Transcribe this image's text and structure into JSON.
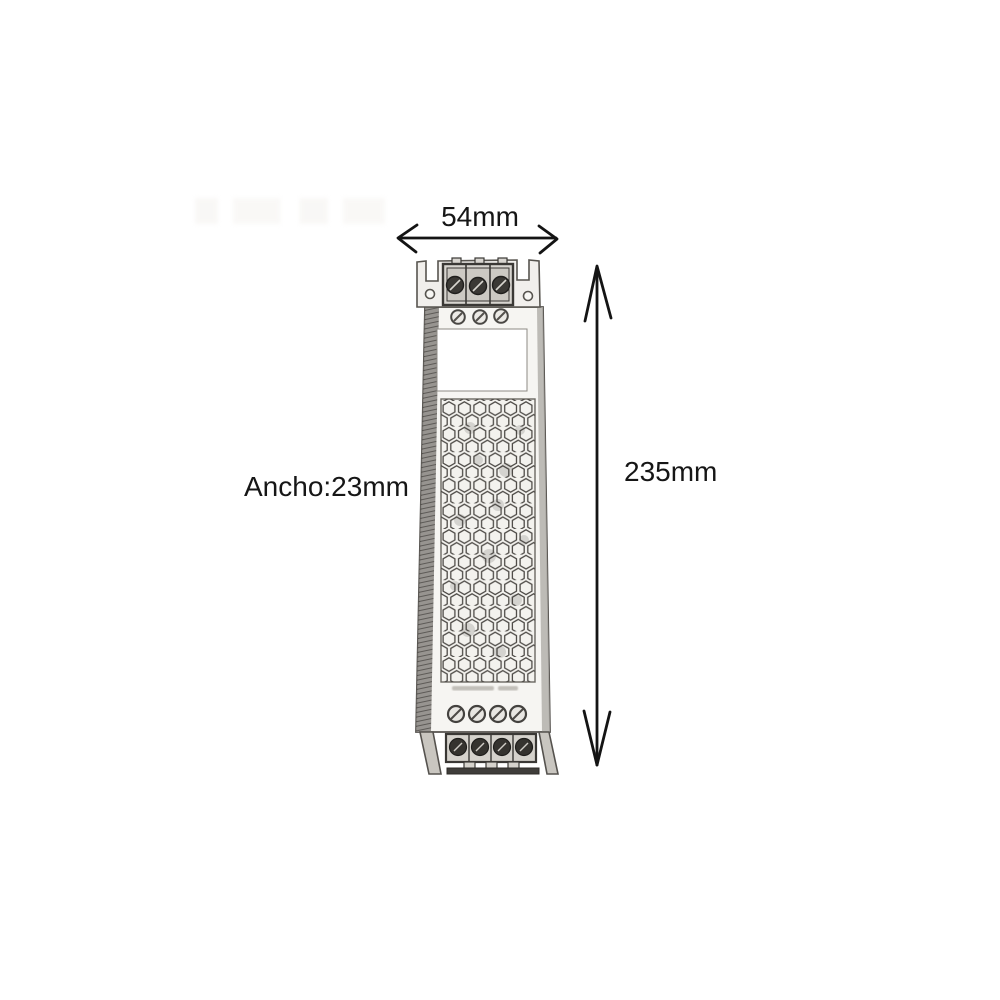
{
  "canvas": {
    "width_px": 1000,
    "height_px": 1000,
    "background": "#ffffff"
  },
  "dimension_labels": {
    "width": "54mm",
    "height": "235mm",
    "depth": "Ancho:23mm"
  },
  "drawing": {
    "subject": "slim LED driver power supply, top view, pencil-sketch style",
    "vent_pattern": "hexagonal honeycomb grille",
    "top_terminal_count": 3,
    "bottom_terminal_count": 4,
    "top_case_screws": 3,
    "bottom_case_screws": 4
  },
  "colors": {
    "dimension_line": "#141414",
    "sketch_stroke": "#4e4b47",
    "body_fill": "#f6f5f2",
    "shade_dark": "#6d6a66",
    "terminal_dark": "#35332f",
    "label_fill": "#ffffff"
  }
}
